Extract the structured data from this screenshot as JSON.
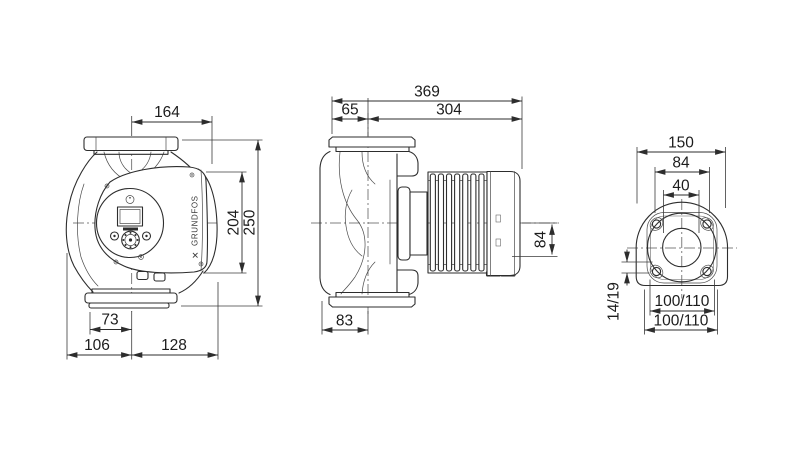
{
  "drawing": {
    "type": "pump-dimensional-drawing",
    "colors": {
      "ink": "#2d2d2d",
      "background": "#ffffff"
    },
    "front_view": {
      "brand": "GRUNDFOS",
      "logo_glyph": "✕",
      "dim_top_width": "164",
      "dim_control_height": "204",
      "dim_overall_height": "250",
      "dim_foot_offset": "73",
      "dim_left_width": "106",
      "dim_right_width": "128"
    },
    "side_view": {
      "dim_overall_length": "369",
      "dim_flange_to_axis": "65",
      "dim_axis_to_end": "304",
      "dim_axis_to_bottom": "84",
      "dim_housing_width": "83"
    },
    "flange_view": {
      "dim_overall_width": "150",
      "dim_head_width": "84",
      "dim_bore": "40",
      "dim_bolt_hole": "14/19",
      "dim_bolt_pitch_inner": "100/110",
      "dim_bolt_pitch_outer": "100/110"
    }
  }
}
